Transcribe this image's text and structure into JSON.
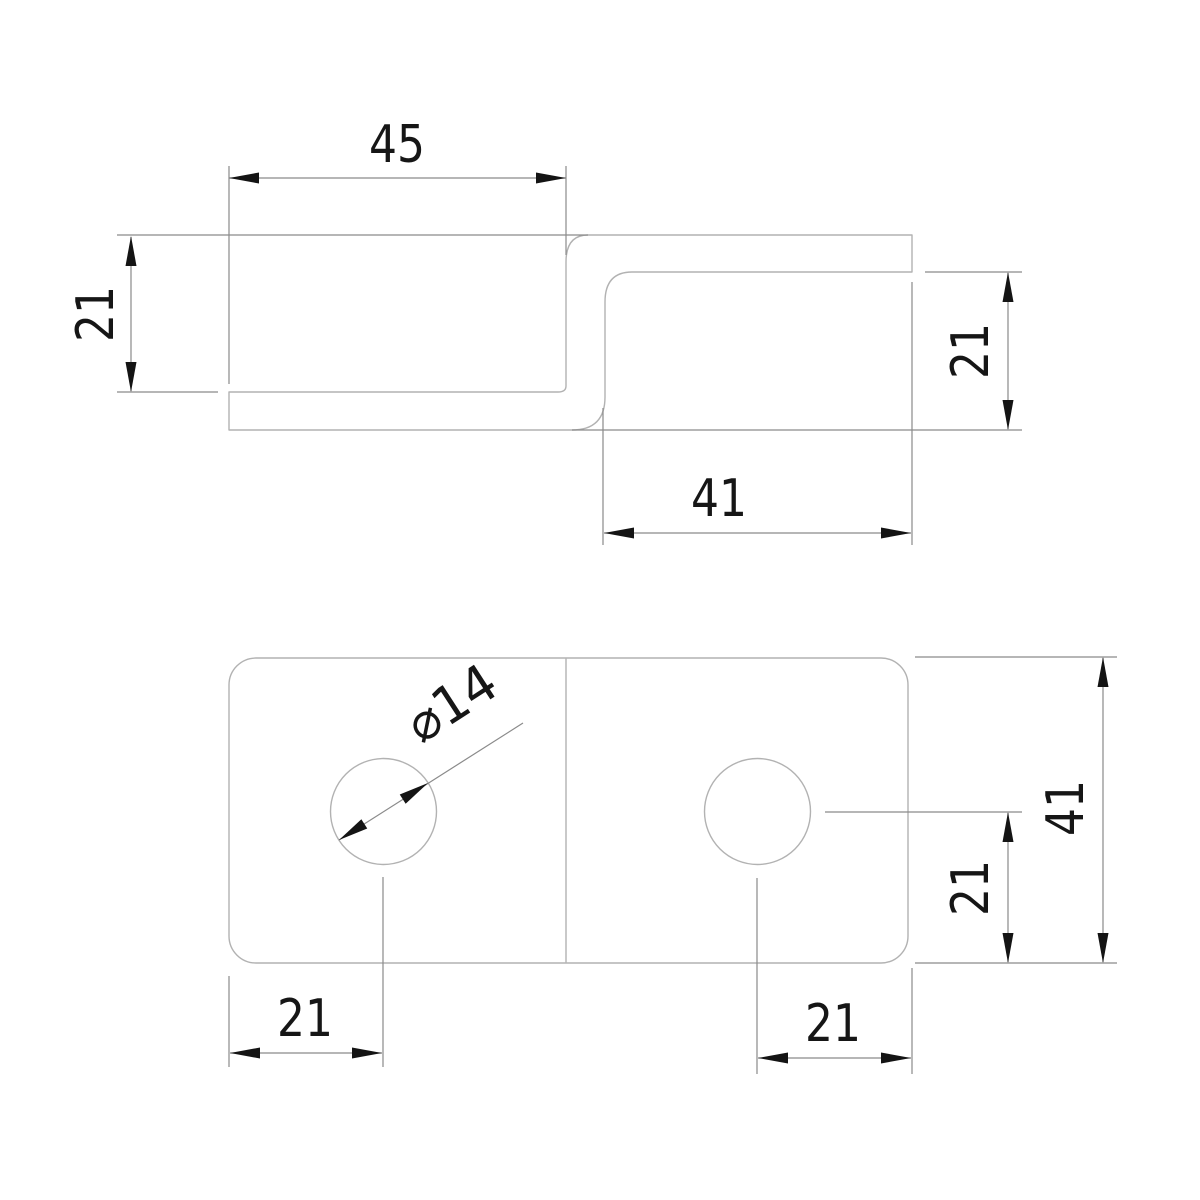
{
  "drawing": {
    "title": "z-bracket-two-view-drawing",
    "colors": {
      "background": "#ffffff",
      "part_line": "#b2b2b2",
      "dim_line": "#8a8a8a",
      "marker": "#141414"
    },
    "stroke": {
      "part_width": 1.4,
      "dim_width": 1.2,
      "arrow_length": 30,
      "arrow_half_width": 5.5
    },
    "font": {
      "size": 52,
      "digit_length_two": 56,
      "digit_length_dia": 96
    },
    "side_view": {
      "name": "side-profile-view",
      "outline_path": "M912,235 L588,235 Q566,235 566,262 L566,386 Q566,392 558,392 L229,392 L229,430 L572,430 Q605,430 605,397 L605,302 Q605,272 632,272 L912,272 Z"
    },
    "plan_view": {
      "name": "plan-view",
      "outline": {
        "x": 229,
        "y": 658,
        "width": 679,
        "height": 305,
        "radius": 27
      },
      "bend_line": {
        "x1": 566,
        "y1": 659,
        "x2": 566,
        "y2": 962
      },
      "holes": [
        {
          "name": "left-hole",
          "cx": 383.5,
          "cy": 811.5,
          "r": 53
        },
        {
          "name": "right-hole",
          "cx": 757.5,
          "cy": 811.5,
          "r": 53
        }
      ]
    },
    "dimensions": [
      {
        "name": "dim-top-flange-45",
        "lines": [
          [
            229,
            166,
            229,
            384
          ],
          [
            566,
            166,
            566,
            255
          ],
          [
            229,
            178,
            566,
            178
          ]
        ],
        "arrows": [
          {
            "tip": [
              229,
              178
            ],
            "dir": [
              -1,
              0
            ]
          },
          {
            "tip": [
              566,
              178
            ],
            "dir": [
              1,
              0
            ]
          }
        ],
        "label": {
          "text": "45",
          "x": 397,
          "y": 145,
          "rotate": 0,
          "len": 56
        }
      },
      {
        "name": "dim-left-offset-21",
        "lines": [
          [
            117,
            235,
            588,
            235
          ],
          [
            117,
            392,
            218,
            392
          ],
          [
            131,
            237,
            131,
            391
          ]
        ],
        "arrows": [
          {
            "tip": [
              131,
              236
            ],
            "dir": [
              0,
              -1
            ]
          },
          {
            "tip": [
              131,
              392
            ],
            "dir": [
              0,
              1
            ]
          }
        ],
        "label": {
          "text": "21",
          "x": 96,
          "y": 314,
          "rotate": -90,
          "len": 56
        }
      },
      {
        "name": "dim-right-offset-21",
        "lines": [
          [
            925,
            272,
            1022,
            272
          ],
          [
            572,
            430,
            1022,
            430
          ],
          [
            1008,
            273,
            1008,
            429
          ]
        ],
        "arrows": [
          {
            "tip": [
              1008,
              272
            ],
            "dir": [
              0,
              -1
            ]
          },
          {
            "tip": [
              1008,
              430
            ],
            "dir": [
              0,
              1
            ]
          }
        ],
        "label": {
          "text": "21",
          "x": 971,
          "y": 351,
          "rotate": -90,
          "len": 56
        }
      },
      {
        "name": "dim-bottom-flange-41",
        "lines": [
          [
            603,
            408,
            603,
            545
          ],
          [
            912,
            282,
            912,
            545
          ],
          [
            604,
            533,
            911,
            533
          ]
        ],
        "arrows": [
          {
            "tip": [
              604,
              533
            ],
            "dir": [
              -1,
              0
            ]
          },
          {
            "tip": [
              911,
              533
            ],
            "dir": [
              1,
              0
            ]
          }
        ],
        "label": {
          "text": "41",
          "x": 719,
          "y": 499,
          "rotate": 0,
          "len": 56
        }
      },
      {
        "name": "dim-hole-diameter-14",
        "lines": [
          [
            339,
            840,
            523,
            723
          ]
        ],
        "arrows": [
          {
            "tip": [
              339,
              840
            ],
            "dir": [
              -0.844,
              0.537
            ]
          },
          {
            "tip": [
              428,
              783
            ],
            "dir": [
              0.844,
              -0.537
            ]
          }
        ],
        "label": {
          "text": "⌀14",
          "x": 452,
          "y": 704,
          "rotate": -33,
          "len": 96
        }
      },
      {
        "name": "dim-left-hole-edge-21",
        "lines": [
          [
            229,
            976,
            229,
            1067
          ],
          [
            383,
            877,
            383,
            1067
          ],
          [
            230,
            1053,
            382,
            1053
          ]
        ],
        "arrows": [
          {
            "tip": [
              230,
              1053
            ],
            "dir": [
              -1,
              0
            ]
          },
          {
            "tip": [
              382,
              1053
            ],
            "dir": [
              1,
              0
            ]
          }
        ],
        "label": {
          "text": "21",
          "x": 305,
          "y": 1019,
          "rotate": 0,
          "len": 56
        }
      },
      {
        "name": "dim-right-hole-edge-21",
        "lines": [
          [
            757,
            878,
            757,
            1074
          ],
          [
            912,
            968,
            912,
            1074
          ],
          [
            758,
            1058,
            911,
            1058
          ]
        ],
        "arrows": [
          {
            "tip": [
              758,
              1058
            ],
            "dir": [
              -1,
              0
            ]
          },
          {
            "tip": [
              911,
              1058
            ],
            "dir": [
              1,
              0
            ]
          }
        ],
        "label": {
          "text": "21",
          "x": 833,
          "y": 1024,
          "rotate": 0,
          "len": 56
        }
      },
      {
        "name": "dim-right-hole-center-21",
        "lines": [
          [
            825,
            812,
            1022,
            812
          ],
          [
            915,
            963,
            1117,
            963
          ],
          [
            1008,
            813,
            1008,
            962
          ]
        ],
        "arrows": [
          {
            "tip": [
              1008,
              812
            ],
            "dir": [
              0,
              -1
            ]
          },
          {
            "tip": [
              1008,
              963
            ],
            "dir": [
              0,
              1
            ]
          }
        ],
        "label": {
          "text": "21",
          "x": 971,
          "y": 888,
          "rotate": -90,
          "len": 56
        }
      },
      {
        "name": "dim-overall-width-41",
        "lines": [
          [
            915,
            657,
            1117,
            657
          ],
          [
            1103,
            658,
            1103,
            962
          ]
        ],
        "arrows": [
          {
            "tip": [
              1103,
              657
            ],
            "dir": [
              0,
              -1
            ]
          },
          {
            "tip": [
              1103,
              963
            ],
            "dir": [
              0,
              1
            ]
          }
        ],
        "label": {
          "text": "41",
          "x": 1066,
          "y": 808,
          "rotate": -90,
          "len": 56
        }
      }
    ]
  }
}
